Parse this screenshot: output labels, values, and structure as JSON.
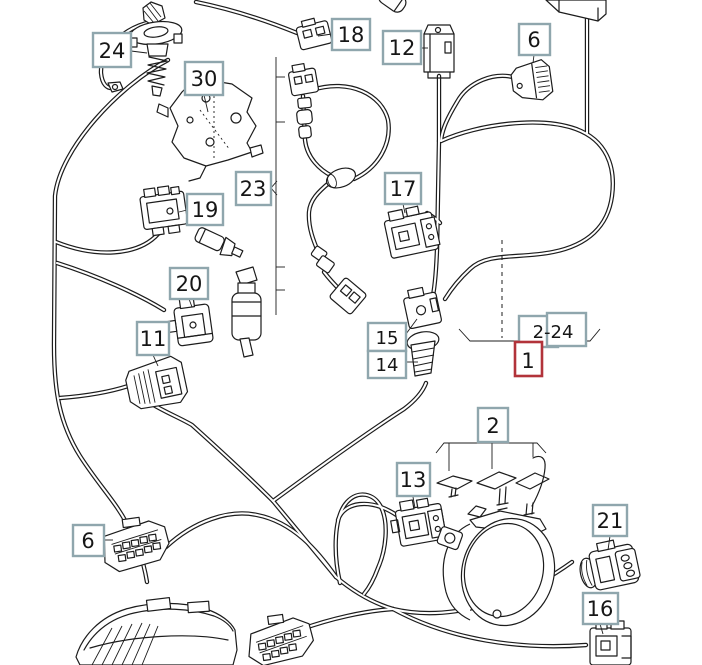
{
  "diagram": {
    "title": "front lighting wiring harness parts diagram",
    "background": "#ffffff",
    "line_color": "#1c1c1c",
    "callout_border_color": "#8fa6ad",
    "highlight_border_color": "#b2333a",
    "text_color": "#161616"
  },
  "callouts": {
    "c24": {
      "label": "24"
    },
    "c30": {
      "label": "30"
    },
    "c18": {
      "label": "18"
    },
    "c12": {
      "label": "12"
    },
    "c6_top": {
      "label": "6"
    },
    "c23": {
      "label": "23"
    },
    "c17": {
      "label": "17"
    },
    "c19": {
      "label": "19"
    },
    "c20": {
      "label": "20"
    },
    "c11": {
      "label": "11"
    },
    "c15": {
      "label": "15"
    },
    "c14": {
      "label": "14"
    },
    "c2_24": {
      "label": "2-24"
    },
    "c1": {
      "label": "1",
      "highlighted": true
    },
    "c2": {
      "label": "2"
    },
    "c13": {
      "label": "13"
    },
    "c21": {
      "label": "21"
    },
    "c16": {
      "label": "16"
    },
    "c6_bottom": {
      "label": "6"
    }
  }
}
